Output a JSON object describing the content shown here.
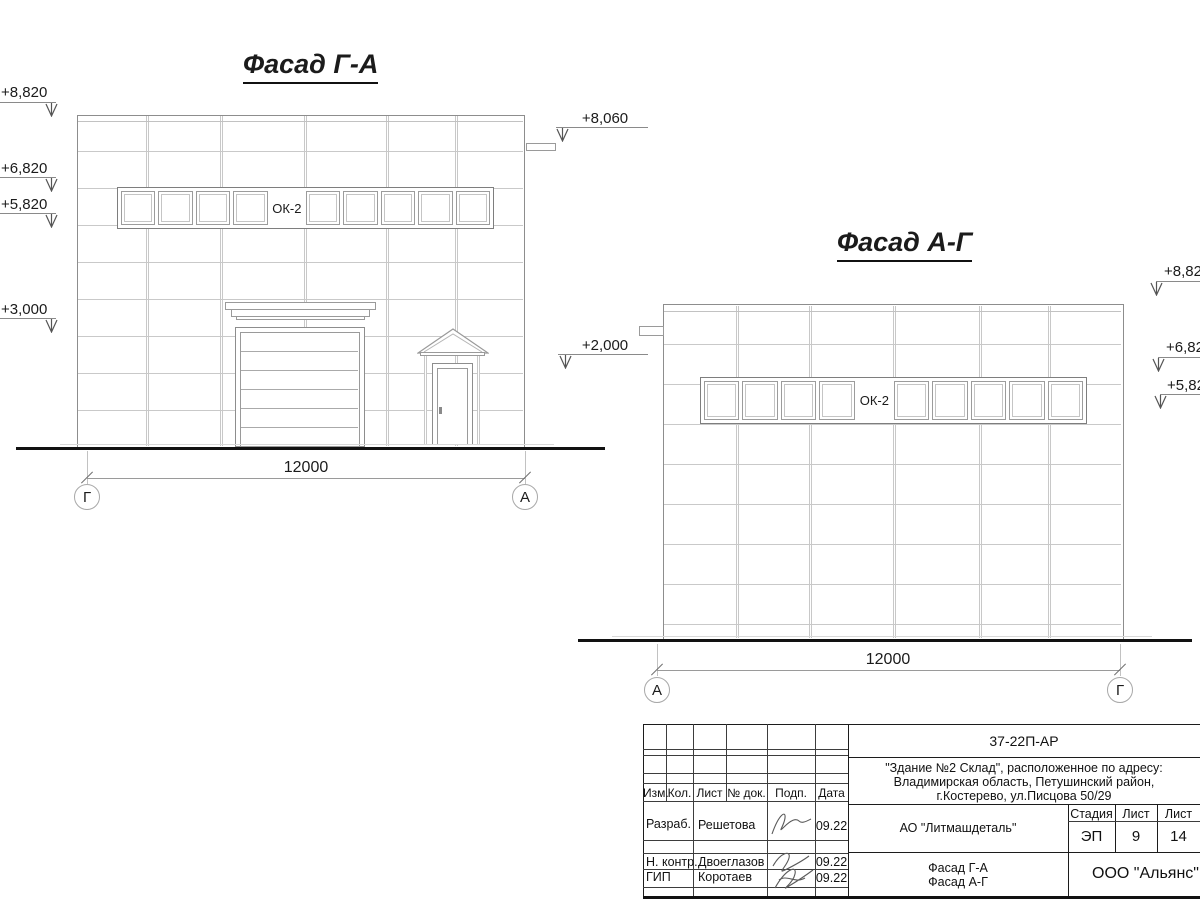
{
  "facade_ga": {
    "title": "Фасад Г-А",
    "window_label": "ОК-2",
    "dimension": "12000",
    "axis_left": "Г",
    "axis_right": "А",
    "elev": {
      "e8820": "+8,820",
      "e6820": "+6,820",
      "e5820": "+5,820",
      "e3000": "+3,000",
      "e8060": "+8,060",
      "e2000": "+2,000"
    }
  },
  "facade_ag": {
    "title": "Фасад А-Г",
    "window_label": "ОК-2",
    "dimension": "12000",
    "axis_left": "А",
    "axis_right": "Г",
    "elev": {
      "e882": "+8,82",
      "e682": "+6,82",
      "e582": "+5,82"
    }
  },
  "title_block": {
    "doc_number": "37-22П-АР",
    "address1": "\"Здание №2 Склад\", расположенное по адресу:",
    "address2": "Владимирская область, Петушинский район,",
    "address3": "г.Костерево, ул.Писцова 50/29",
    "col_izm": "Изм.",
    "col_kol": "Кол.",
    "col_list": "Лист",
    "col_doc": "№ док.",
    "col_podp": "Подп.",
    "col_data": "Дата",
    "row1_role": "Разраб.",
    "row1_name": "Решетова",
    "row1_date": "09.22",
    "row2_role": "Н. контр.",
    "row2_name": "Двоеглазов",
    "row2_date": "09.22",
    "row3_role": "ГИП",
    "row3_name": "Коротаев",
    "row3_date": "09.22",
    "client": "АО \"Литмашдеталь\"",
    "stage_label": "Стадия",
    "sheet_label": "Лист",
    "total_label": "Лист",
    "stage": "ЭП",
    "sheet": "9",
    "total": "14",
    "title1": "Фасад Г-А",
    "title2": "Фасад А-Г",
    "org": "ООО \"Альянс\""
  }
}
